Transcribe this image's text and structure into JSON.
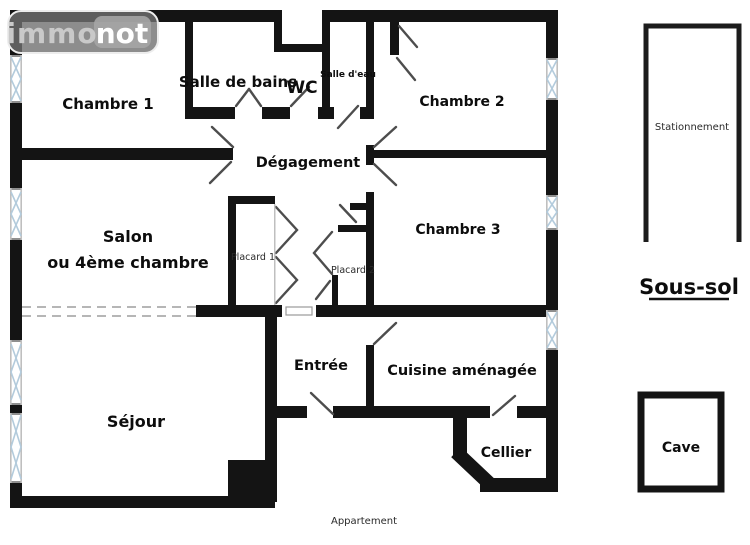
{
  "logo": {
    "immo": "immo",
    "not": "not"
  },
  "rooms": {
    "chambre1": "Chambre 1",
    "salle_de_bains": "Salle de bains",
    "wc": "WC",
    "salle_deau": "Salle d'eau",
    "chambre2": "Chambre 2",
    "degagement": "Dégagement",
    "salon_line1": "Salon",
    "salon_line2": "ou 4ème chambre",
    "chambre3": "Chambre 3",
    "placard1": "Placard 1",
    "placard2": "Placard 2",
    "entree": "Entrée",
    "cuisine": "Cuisine aménagée",
    "sejour": "Séjour",
    "cellier": "Cellier"
  },
  "basement": {
    "stationnement": "Stationnement",
    "title": "Sous-sol",
    "cave": "Cave"
  },
  "captions": {
    "apartment": "Appartement"
  },
  "colors": {
    "wall": "#141414",
    "background": "#ffffff",
    "door_line": "#4d4d4d",
    "window_line": "#b3cbdc",
    "dashed_line": "#9e9e9e",
    "logo_gray": "#7d7d7d"
  }
}
